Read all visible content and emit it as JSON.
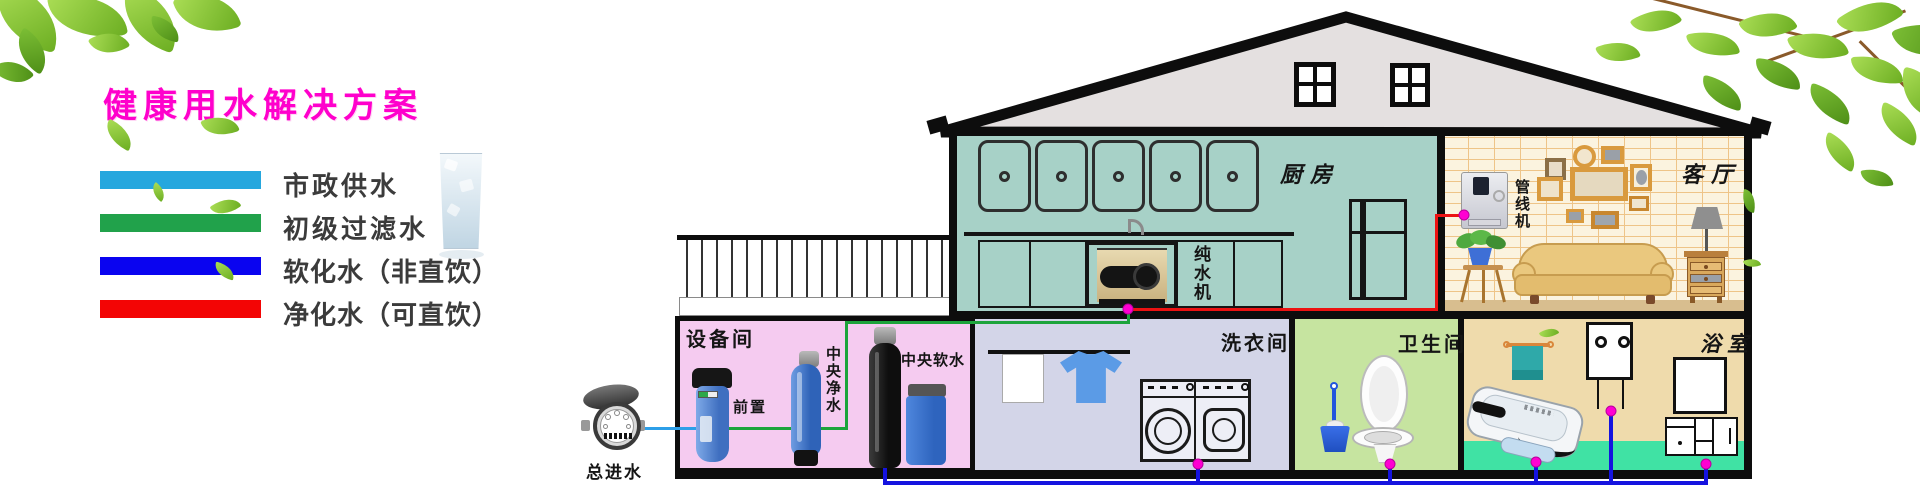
{
  "title": {
    "text": "健康用水解决方案",
    "color": "#FF00CC"
  },
  "legend": {
    "items": [
      {
        "label": "市政供水",
        "color": "#25A7DE"
      },
      {
        "label": "初级过滤水",
        "color": "#21A24B"
      },
      {
        "label": "软化水（非直饮）",
        "color": "#0A04F0"
      },
      {
        "label": "净化水（可直饮）",
        "color": "#F30505"
      }
    ]
  },
  "outdoor": {
    "water_meter_label": "总进水"
  },
  "rooms": {
    "equipment": {
      "label": "设备间",
      "wall_color": "#F5CBF0",
      "devices": {
        "prefilter": "前置",
        "purifier": "中央净水",
        "softener": "中央软水"
      }
    },
    "kitchen": {
      "label": "厨房",
      "machine": "纯水机",
      "wall_color": "#A7D1C7"
    },
    "living": {
      "label": "客厅",
      "machine": "管线机",
      "wall_color": "#FBF3DF"
    },
    "laundry": {
      "label": "洗衣间",
      "wall_color": "#D3D5E8"
    },
    "toilet": {
      "label": "卫生间",
      "wall_color": "#C6E4A0"
    },
    "bath": {
      "label": "浴室",
      "wall_color": "#EFDBAC"
    }
  },
  "pipes": {
    "municipal": "#2D9FE8",
    "filtered": "#1CA43B",
    "softened": "#1513DF",
    "purified": "#EC1212",
    "junction_dot": "#FF00D2"
  }
}
